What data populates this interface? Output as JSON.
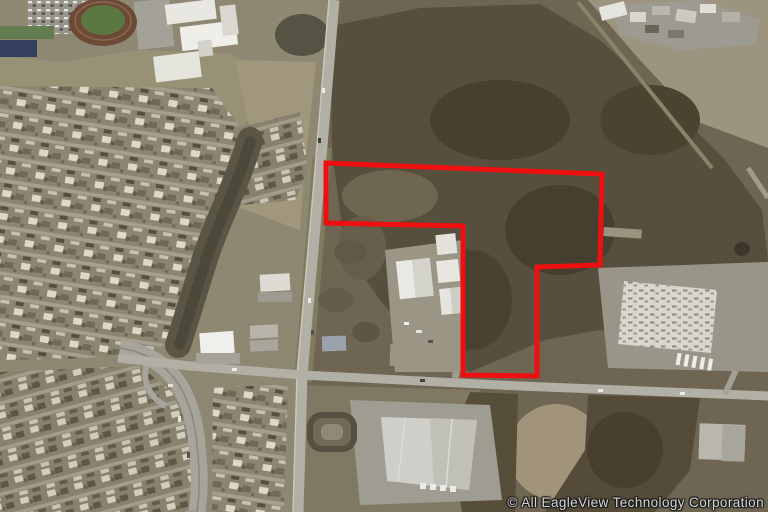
{
  "watermark": {
    "text": "© All EagleView Technology Corporation",
    "color": "#d6d6d6"
  },
  "annotation": {
    "parcel_outline": {
      "points": "326,163 602,174 600,265 537,267 537,376 463,375 463,226 326,223",
      "color": "#ee1010",
      "stroke_width": 5
    }
  }
}
